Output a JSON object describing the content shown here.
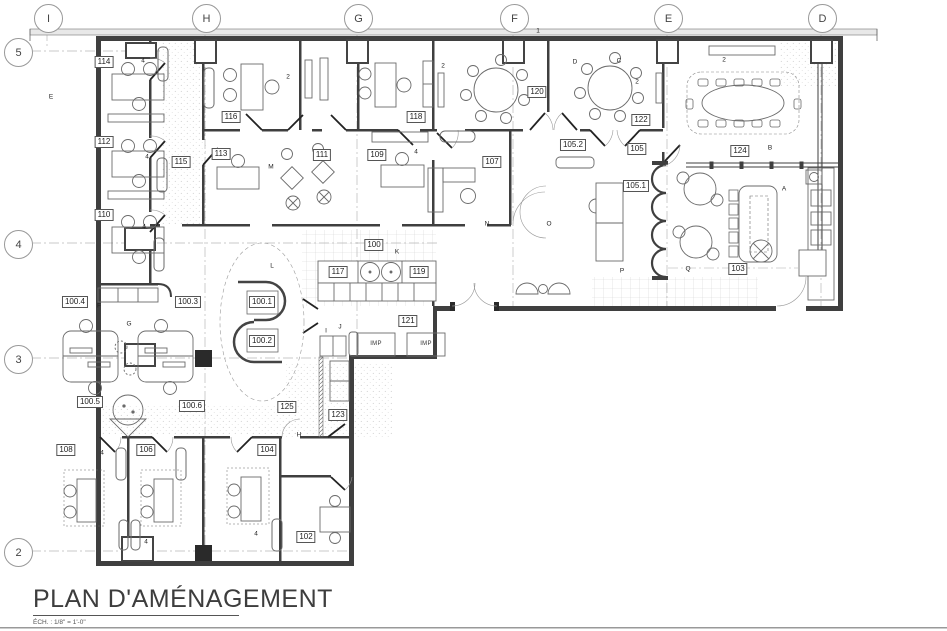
{
  "sheet": {
    "title": "PLAN D'AMÉNAGEMENT",
    "scale_note": "ÉCH. : 1/8\" = 1'-0\""
  },
  "grid": {
    "columns": [
      "I",
      "H",
      "G",
      "F",
      "E",
      "D"
    ],
    "rows": [
      "5",
      "4",
      "3",
      "2"
    ]
  },
  "rooms": {
    "r114": "114",
    "r112": "112",
    "r110": "110",
    "r115": "115",
    "r116": "116",
    "r113": "113",
    "r111": "111",
    "r118": "118",
    "r109": "109",
    "r107": "107",
    "r120": "120",
    "r105_2": "105.2",
    "r122": "122",
    "r105": "105",
    "r105_1": "105.1",
    "r124": "124",
    "r103": "103",
    "r100": "100",
    "r117": "117",
    "r119": "119",
    "r121": "121",
    "r100_1": "100.1",
    "r100_2": "100.2",
    "r100_3": "100.3",
    "r100_4": "100.4",
    "r100_5": "100.5",
    "r100_6": "100.6",
    "r125": "125",
    "r123": "123",
    "r108": "108",
    "r106": "106",
    "r104": "104",
    "r102": "102"
  },
  "equipment": {
    "printer": "IMP"
  },
  "annotations": {
    "a": "A",
    "b": "B",
    "c": "C",
    "d": "D",
    "e": "E",
    "f": "F",
    "g": "G",
    "h": "H",
    "i": "I",
    "j": "J",
    "k": "K",
    "l": "L",
    "m": "M",
    "n": "N",
    "o": "O",
    "p": "P",
    "q": "Q",
    "num1": "1",
    "num2": "2",
    "num4": "4"
  },
  "colors": {
    "wall": "#3f3f3f",
    "furniture_line": "#6a6a6a",
    "grid_dash": "#b8b8b8",
    "paper": "#ffffff"
  }
}
